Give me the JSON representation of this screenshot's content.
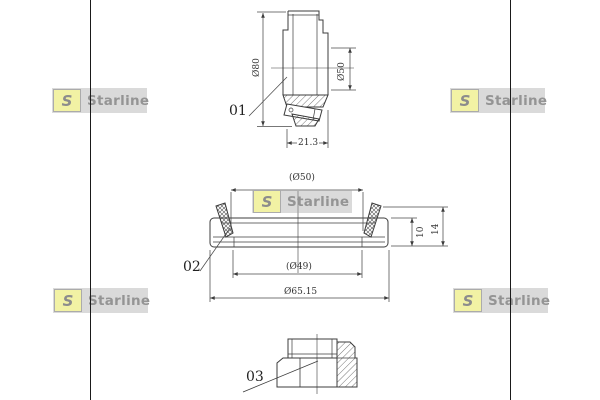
{
  "colors": {
    "background": "#ffffff",
    "drawing_line": "#3c3c3c",
    "rule_line": "#1a1a1a",
    "watermark_text": "#949494",
    "watermark_logo_yellow": "#f2f2a4"
  },
  "watermark": {
    "letter": "S",
    "brand": "Starline"
  },
  "figures": {
    "bearing": {
      "label": "01",
      "dim_outer_diameter": "Ø80",
      "dim_bore_diameter": "Ø50",
      "dim_width": "21.3"
    },
    "seal": {
      "label": "02",
      "dim_lip_diameter": "(Ø50)",
      "dim_inner_diameter": "(Ø49)",
      "dim_outer_diameter": "Ø65.15",
      "dim_insert_height": "10",
      "dim_total_height": "14"
    },
    "nut": {
      "label": "03"
    }
  }
}
